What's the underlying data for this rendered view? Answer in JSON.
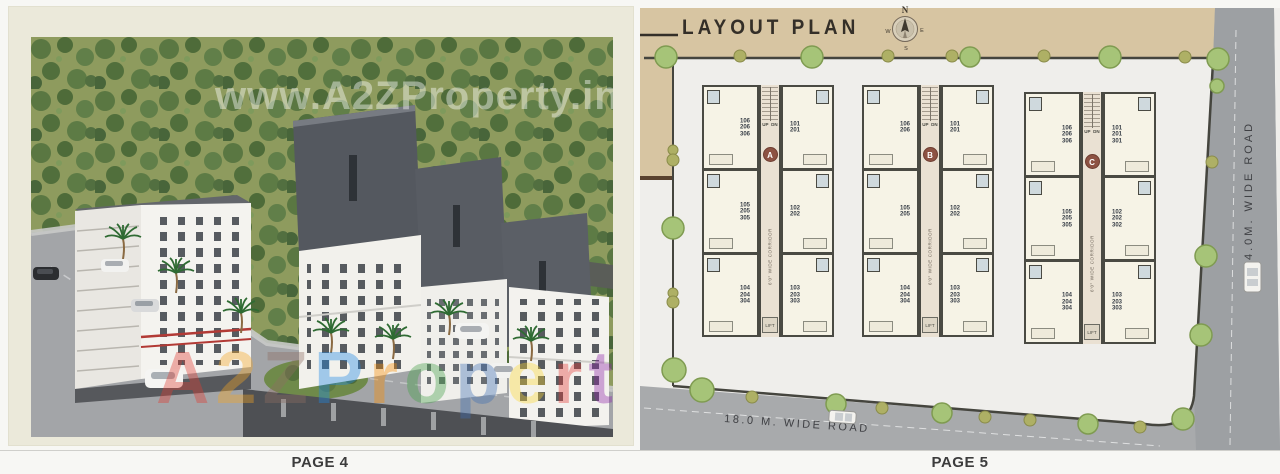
{
  "pages": {
    "left": "PAGE 4",
    "right": "PAGE 5"
  },
  "watermark": {
    "top": "www.A2ZProperty.in",
    "letters": [
      "A",
      "2",
      "Z",
      "P",
      "r",
      "o",
      "p",
      "e",
      "r",
      "t",
      "y"
    ]
  },
  "layout_plan": {
    "title": "LAYOUT PLAN",
    "compass": {
      "n": "N",
      "e": "E",
      "w": "W",
      "s": "S"
    },
    "roads": {
      "right": "24.0M. WIDE ROAD",
      "bottom": "18.0 M. WIDE ROAD"
    },
    "corridor_label": "6'0\" WIDE CORRIDOR",
    "stairs": {
      "up": "UP",
      "dn": "DN"
    },
    "lift": "LIFT",
    "blocks": [
      {
        "id": "A",
        "units": [
          "106\n206\n306",
          "101\n201",
          "105\n205\n305",
          "102\n202",
          "104\n204\n304",
          "103\n203\n303"
        ]
      },
      {
        "id": "B",
        "units": [
          "106\n206",
          "101\n201",
          "105\n205",
          "102\n202",
          "104\n204\n304",
          "103\n203\n303"
        ]
      },
      {
        "id": "C",
        "units": [
          "106\n206\n306",
          "101\n201\n301",
          "105\n205\n305",
          "102\n202\n302",
          "104\n204\n304",
          "103\n203\n303"
        ]
      }
    ]
  },
  "colors": {
    "tan_band": "#d7c5a2",
    "road_gray": "#a8aaac",
    "tree_green": "#a6c478",
    "badge_maroon": "#8d5243",
    "plot_bg": "#efeeeb"
  }
}
